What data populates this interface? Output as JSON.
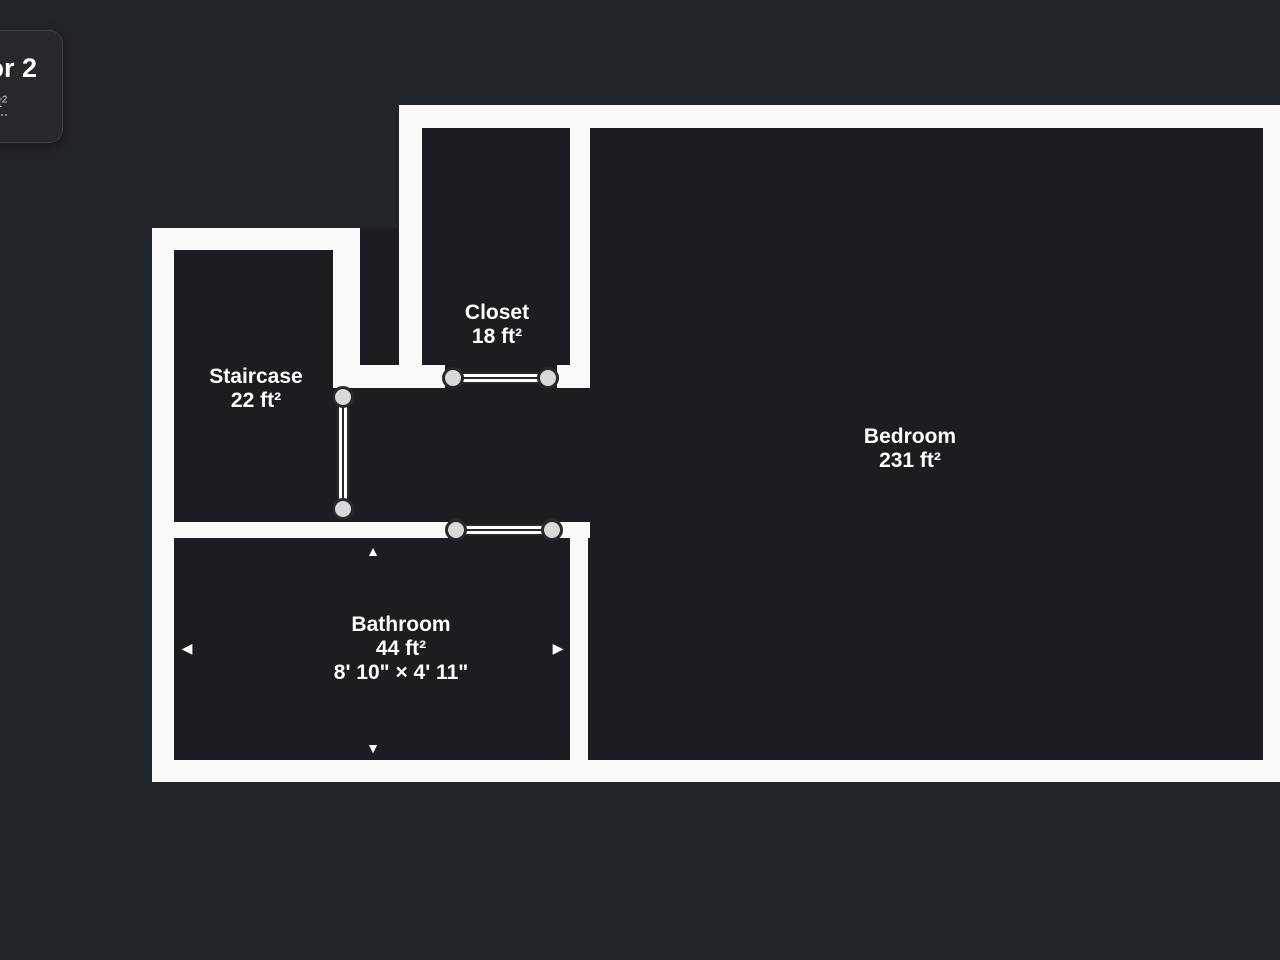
{
  "floor_card": {
    "title": "Floor 2",
    "area_label": "ft²"
  },
  "rooms": [
    {
      "name": "Closet",
      "area": "18 ft²"
    },
    {
      "name": "Staircase",
      "area": "22 ft²"
    },
    {
      "name": "Bedroom",
      "area": "231 ft²"
    },
    {
      "name": "Bathroom",
      "area": "44 ft²",
      "dimensions": "8' 10\" × 4' 11\""
    }
  ],
  "icons": {
    "resize_up": "▲",
    "resize_down": "▼",
    "resize_left": "◀",
    "resize_right": "▶"
  },
  "colors": {
    "background": "#222528",
    "room_fill": "#1b1d20",
    "wall": "#fafafa",
    "door_handle_fill": "#d9d9d9",
    "door_outline": "#26292c",
    "card_background": "#26282c",
    "text": "#ffffff",
    "muted_text": "#b9bbbe"
  }
}
